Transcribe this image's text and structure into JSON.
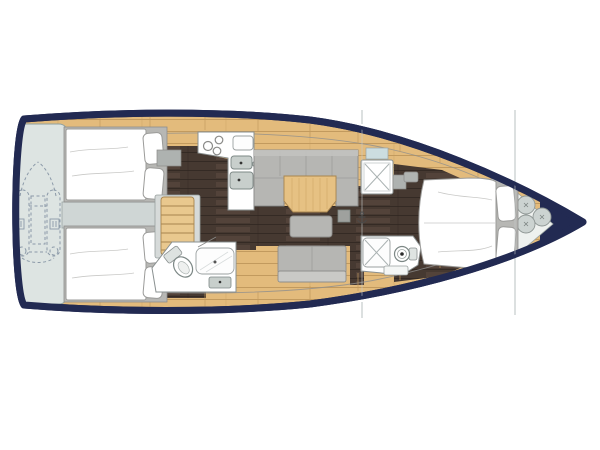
{
  "meta": {
    "description": "Top-down interior layout plan of a sailing yacht, bow pointing right, no visible text labels"
  },
  "colors": {
    "background": "#ffffff",
    "hull_navy": "#222a52",
    "deck_wood": "#e3bb7c",
    "deck_wood_line": "#c29a5e",
    "floor_dark": "#463931",
    "floor_dark_streak": "#6a564a",
    "upholstery_gray": "#b6b6b3",
    "upholstery_light": "#c9c9c6",
    "furniture_base_gray": "#b7b7b4",
    "platform_blue": "#dde4e2",
    "walkway_gray": "#cfd6d5",
    "stairs_wood": "#e9c88e",
    "stairs_line": "#a8854f",
    "table_wood": "#e6c183",
    "white_fixture": "#ffffff",
    "fixture_outline": "#8a9090",
    "sink_gray": "#c8cfcc",
    "window_blue": "#ccdde0",
    "section_line": "#c5cbcb",
    "dinghy_outline": "#8b99a8",
    "mattress_outline": "#9b9b99",
    "bow_seat_bg": "#eef1ef",
    "cushion_gray": "#ccd3d1"
  },
  "regions": [
    {
      "id": "hull",
      "label": "yacht hull outline, bow to the right"
    },
    {
      "id": "stern-platform",
      "label": "stern garage platform with stowed dinghy (dashed)"
    },
    {
      "id": "tender-dinghy",
      "label": "inflatable tender drawn dashed on stern platform"
    },
    {
      "id": "cockpit-walkway",
      "label": "passage from stern platform to companionway"
    },
    {
      "id": "aft-cabin-port",
      "label": "aft double cabin, upper"
    },
    {
      "id": "aft-cabin-starboard",
      "label": "aft double cabin, lower"
    },
    {
      "id": "companionway-stairs",
      "label": "companionway steps"
    },
    {
      "id": "galley",
      "label": "L-shaped galley with 3-burner stove and twin sinks"
    },
    {
      "id": "salon",
      "label": "U-shaped settee with folding table and ottoman"
    },
    {
      "id": "salon-sofa",
      "label": "straight sofa opposite the salon table"
    },
    {
      "id": "aft-head",
      "label": "aft bathroom with toilet, shower tray and sink"
    },
    {
      "id": "shower-stall",
      "label": "separate shower stall with X tray"
    },
    {
      "id": "fwd-head",
      "label": "forward bathroom with shower and toilet"
    },
    {
      "id": "owner-cabin",
      "label": "forward owner cabin with island double berth"
    },
    {
      "id": "bow-seating",
      "label": "bow seat area with three round cushions"
    },
    {
      "id": "mast-line",
      "label": "mast section line with anchor point symbol"
    },
    {
      "id": "forestay-line",
      "label": "forestay section line near the bow"
    }
  ]
}
